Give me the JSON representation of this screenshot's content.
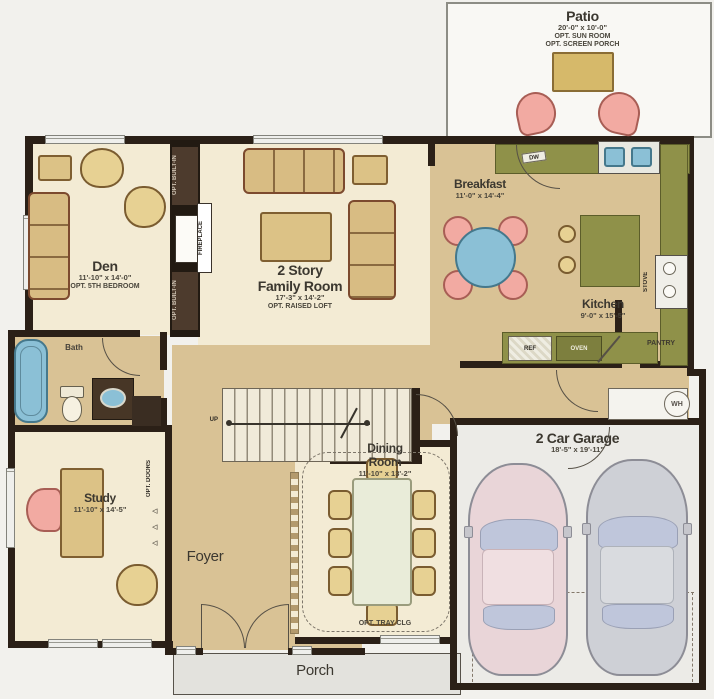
{
  "rooms": {
    "patio": {
      "name": "Patio",
      "dims": "20'-0\" x 10'-0\"",
      "opt1": "OPT. SUN ROOM",
      "opt2": "OPT. SCREEN PORCH"
    },
    "den": {
      "name": "Den",
      "dims": "11'-10\" x 14'-0\"",
      "opt1": "OPT. 5TH BEDROOM"
    },
    "family": {
      "line1": "2 Story",
      "line2": "Family Room",
      "dims": "17'-3\" x 14'-2\"",
      "opt1": "OPT. RAISED LOFT"
    },
    "breakfast": {
      "name": "Breakfast",
      "dims": "11'-0\" x 14'-4\""
    },
    "kitchen": {
      "name": "Kitchen",
      "dims": "9'-0\" x 15'-5\""
    },
    "bath": {
      "name": "Bath"
    },
    "study": {
      "name": "Study",
      "dims": "11'-10\" x 14'-5\""
    },
    "foyer": {
      "name": "Foyer"
    },
    "dining": {
      "line1": "Dining",
      "line2": "Room",
      "dims": "11'-10\" x 13'-2\"",
      "opt1": "OPT. TRAY CLG"
    },
    "garage": {
      "name": "2 Car Garage",
      "dims": "18'-5\" x 19'-11\""
    },
    "porch": {
      "name": "Porch"
    }
  },
  "fixtures": {
    "fireplace": "FIREPLACE",
    "opt_builtin_top": "OPT. BUILT-IN",
    "opt_builtin_bottom": "OPT. BUILT-IN",
    "opt_doors": "OPT. DOORS",
    "dw": "DW",
    "ref": "REF",
    "oven": "OVEN",
    "stove": "STOVE",
    "pantry": "PANTRY",
    "wh": "WH",
    "up": "UP"
  },
  "colors": {
    "wall": "#2b2017",
    "floor_light": "#f3ebd4",
    "floor_tan": "#d9c295",
    "counter_olive": "#8f9149",
    "accent_blue": "#8bc0d6",
    "accent_pink": "#f2aaa2",
    "garage_floor": "#ecebe7",
    "porch_gray": "#e3e2dd"
  }
}
